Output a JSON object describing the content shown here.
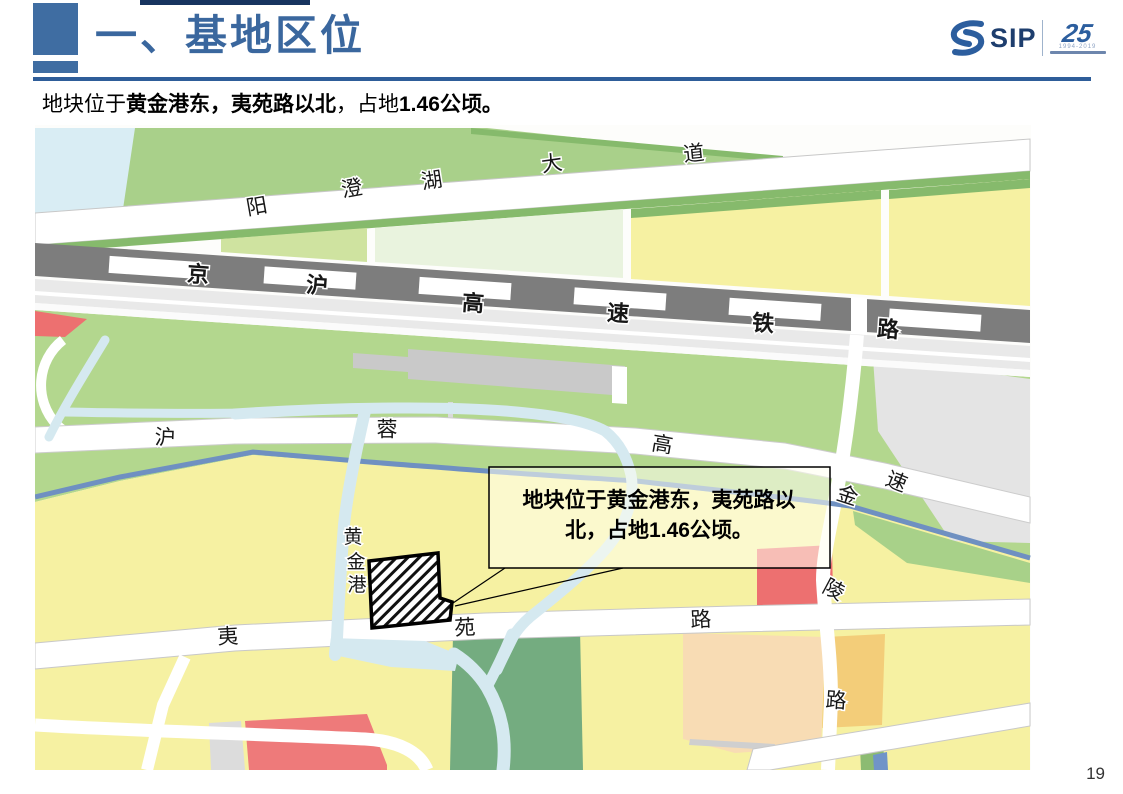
{
  "header": {
    "title": "一、基地区位",
    "subtitle": {
      "s1": "地块位于",
      "s2": "黄金港东，夷苑路以北",
      "s3": "，占地",
      "s4": "1.46公顷。"
    },
    "logo": {
      "sip": "SIP",
      "anniversary": "25",
      "years": "1994-2019"
    }
  },
  "map": {
    "road_labels": {
      "ycdd": [
        "阳",
        "澄",
        "湖",
        "大",
        "道"
      ],
      "rail": [
        "京",
        "沪",
        "高",
        "速",
        "铁",
        "路"
      ],
      "hurong": [
        "沪",
        "蓉",
        "高",
        "速"
      ],
      "jinling": [
        "金",
        "陵",
        "路"
      ],
      "huangjingang": [
        "黄",
        "金",
        "港"
      ],
      "yiyuan": [
        "夷",
        "苑",
        "路"
      ]
    },
    "callout": {
      "line1": "地块位于黄金港东，夷苑路以",
      "line2": "北，占地1.46公顷。"
    },
    "colors": {
      "title_blue": "#3a679e",
      "underline_blue": "#2e5d99",
      "railway_gray": "#7d7d7d",
      "parcel_yellow": "#f6f1a2",
      "parcel_green_light": "#cfe3a0",
      "field_green": "#b3d78e",
      "park_green": "#74ac80",
      "canal_blue": "#d5e9f0",
      "river_blue": "#6f90c1",
      "red_parcel": "#ed7070",
      "peach_parcel": "#f8dcb4",
      "orange_parcel": "#f3cd79"
    }
  },
  "footer": {
    "page_number": "19"
  }
}
